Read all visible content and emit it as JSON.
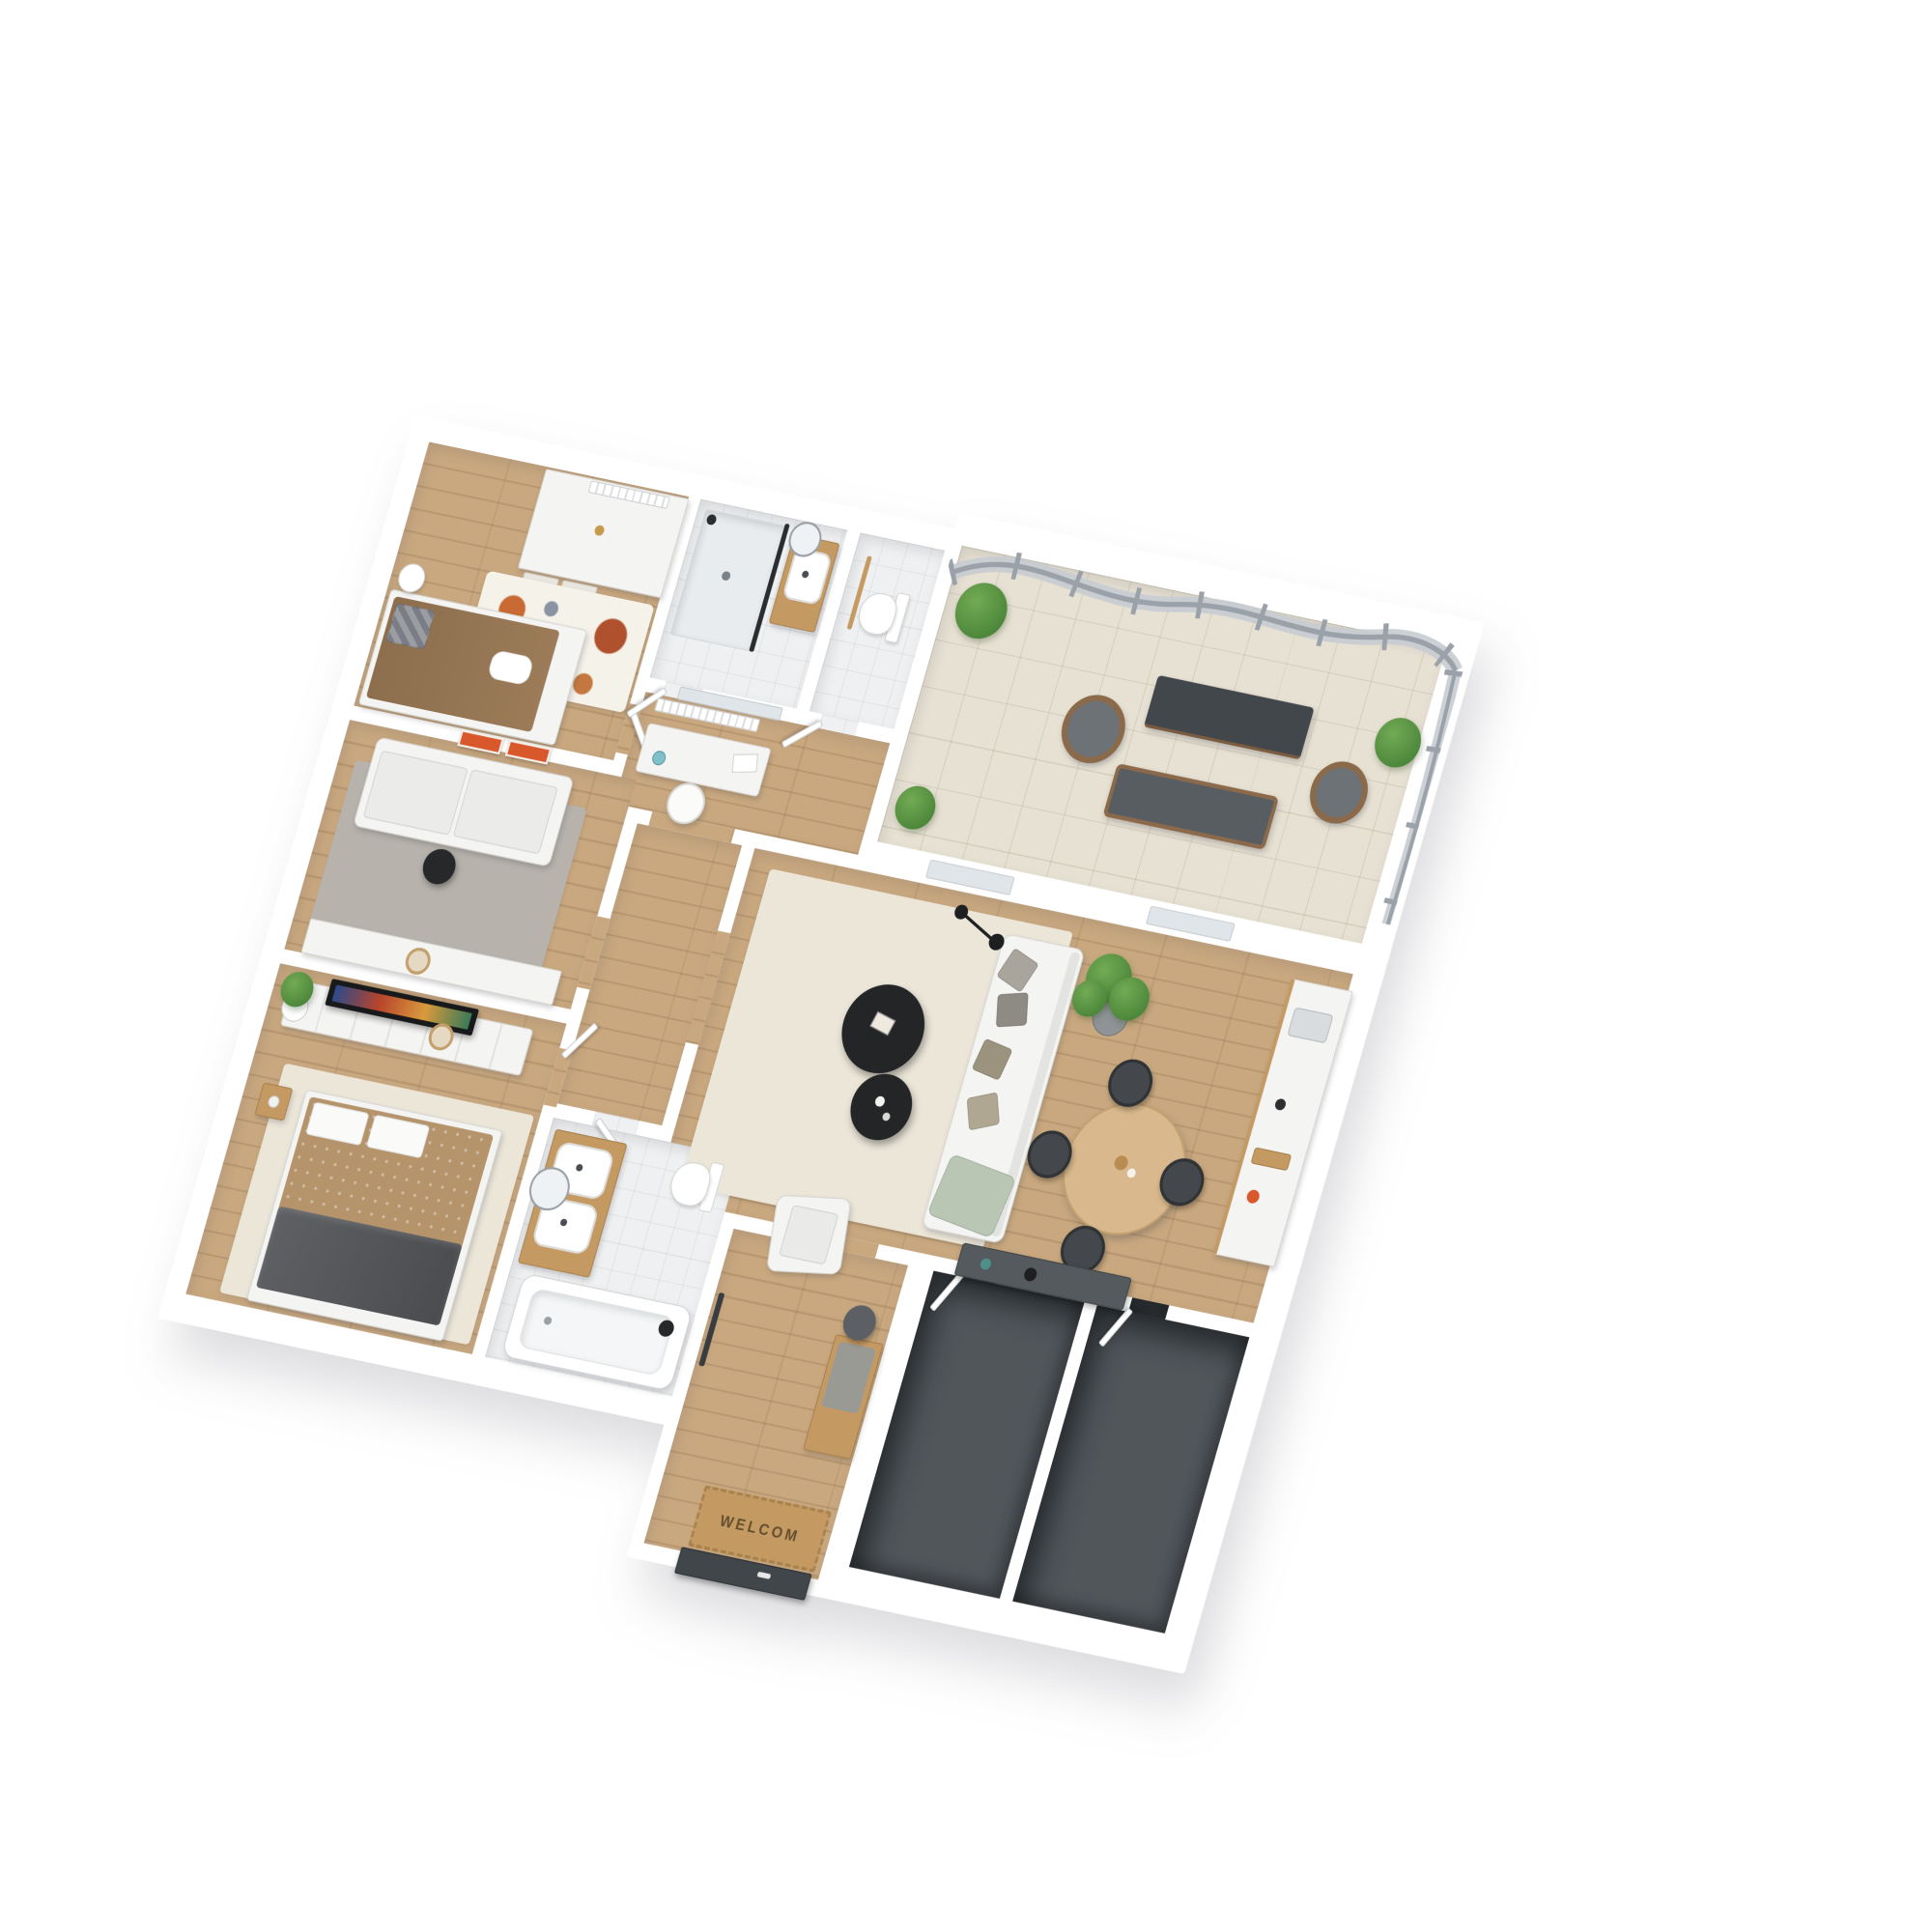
{
  "scene": {
    "type": "isometric-3d-floor-plan-render",
    "background": "#ffffff",
    "doormat_text": "WELCOM"
  },
  "colors": {
    "wall": "#ffffff",
    "wood_floor": "#c9a87f",
    "tile_floor": "#eef0f1",
    "terrace_floor": "#e7e1d3",
    "dark_floor": "#51565b",
    "rug_grey": "#b7b3ac",
    "rug_cream": "#ece6d9",
    "kids_rug": "#f5f2ea",
    "sofa_white": "#f4f4f3",
    "accent_orange": "#d9582b",
    "plant_green": "#3f7a31",
    "bed_tan": "#b5946c",
    "kids_bed_brown": "#9b7b58",
    "blanket_grey": "#5e6063",
    "throw_sage": "#b9c6b4",
    "table_black": "#232527",
    "railing_grey": "#9aa1a9",
    "railing_glass": "#c6ccd2",
    "front_door": "#41464b",
    "wood_furniture": "#c59a62",
    "dining_table_wood": "#d8b88c"
  },
  "rooms": [
    {
      "id": "kids-bedroom",
      "furniture": [
        "wardrobe",
        "storage-boxes",
        "single-bed",
        "plaid-pillow",
        "play-rug",
        "side-table",
        "wall-posters",
        "radiator"
      ]
    },
    {
      "id": "study-nook",
      "furniture": [
        "desk",
        "desk-chair",
        "globe",
        "papers",
        "radiator"
      ]
    },
    {
      "id": "shower-room",
      "furniture": [
        "walk-in-shower",
        "glass-screen",
        "washbasin-vanity",
        "round-mirror"
      ]
    },
    {
      "id": "wc",
      "furniture": [
        "toilet",
        "privacy-screen"
      ]
    },
    {
      "id": "terrace",
      "furniture": [
        "curved-glass-railing",
        "potted-plant-left",
        "potted-plant-right",
        "potted-plant-corner",
        "wicker-armchair-left",
        "wicker-armchair-right",
        "outdoor-table",
        "outdoor-bench"
      ]
    },
    {
      "id": "tv-lounge",
      "furniture": [
        "two-seat-sofa",
        "speaker-side-table",
        "grey-rug",
        "sideboard",
        "decor-basket"
      ]
    },
    {
      "id": "living-dining-room",
      "furniture": [
        "three-seat-sofa",
        "scatter-pillows",
        "sage-throw",
        "cream-rug",
        "round-coffee-table-large",
        "round-coffee-table-small",
        "armchair",
        "floor-lamp",
        "fiddle-leaf-plant",
        "round-dining-table",
        "dining-chair-north",
        "dining-chair-east",
        "dining-chair-south",
        "dining-chair-west",
        "kitchen-counter",
        "kitchen-sink",
        "fruit-bowl",
        "dark-console",
        "vases"
      ]
    },
    {
      "id": "master-bedroom",
      "furniture": [
        "double-bed",
        "pillows",
        "grey-blanket",
        "cream-rug",
        "tv-sideboard",
        "wall-tv",
        "potted-plant",
        "nightstand"
      ]
    },
    {
      "id": "bathroom",
      "furniture": [
        "bathtub",
        "shower-head",
        "double-washbasin-vanity",
        "round-mirror",
        "toilet"
      ]
    },
    {
      "id": "entry-hall",
      "furniture": [
        "coat-rack",
        "hall-bench",
        "wall-mirror",
        "doormat",
        "front-door"
      ]
    },
    {
      "id": "storage-room-a",
      "furniture": []
    },
    {
      "id": "storage-room-b",
      "furniture": []
    }
  ]
}
